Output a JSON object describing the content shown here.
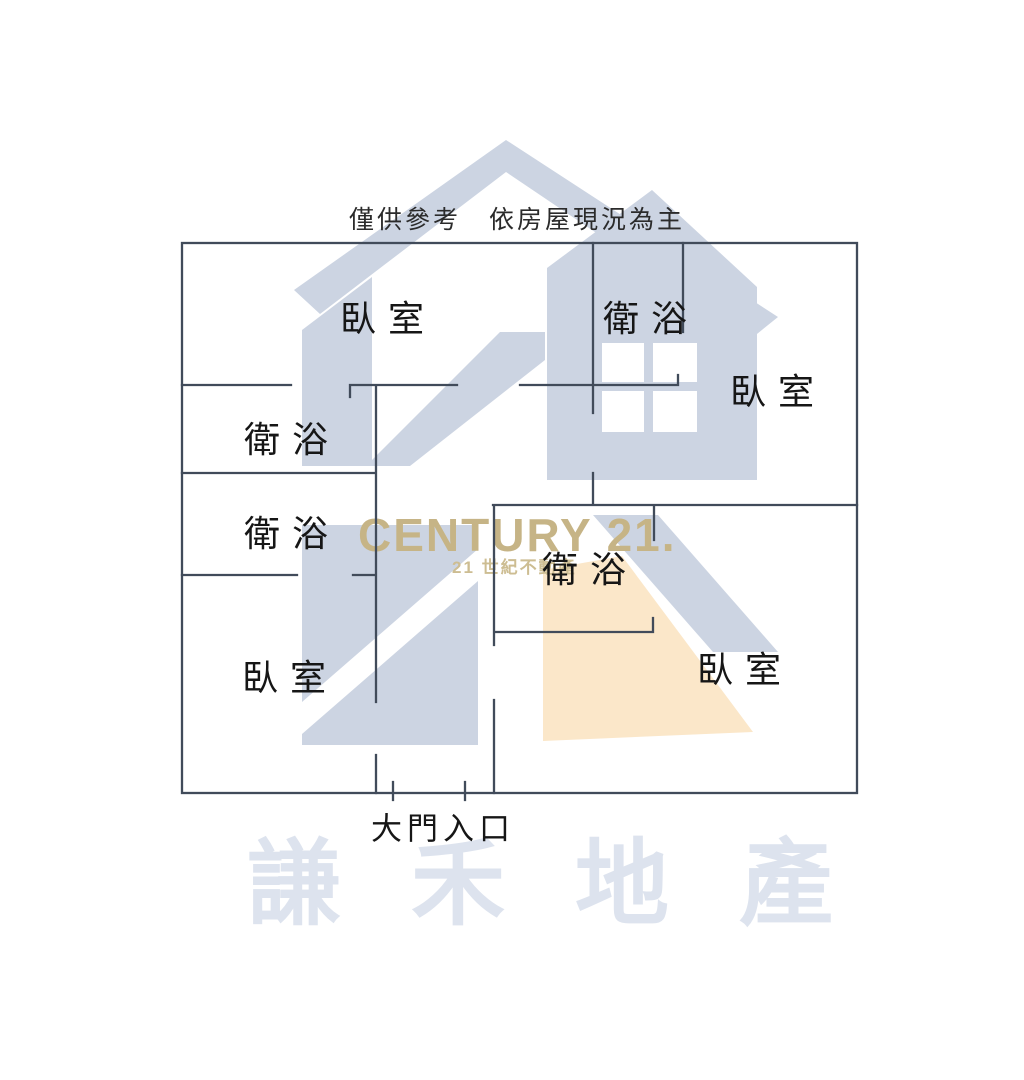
{
  "disclaimer": "僅供參考　依房屋現況為主",
  "rooms": {
    "bedroom_top_left": "臥室",
    "bath_top": "衛浴",
    "bedroom_top_right": "臥室",
    "bath_left_upper": "衛浴",
    "bath_left_lower": "衛浴",
    "bedroom_bottom_left": "臥室",
    "bath_center": "衛浴",
    "bedroom_bottom_right": "臥室"
  },
  "entrance": {
    "label": "大門入口"
  },
  "watermarks": {
    "brand": "CENTURY 21.",
    "brand_sub": "21 世紀不動產",
    "agency": "謙禾地產",
    "colors": {
      "brand_gold": "#c6b486",
      "logo_blue": "#ccd4e2",
      "logo_peach": "#fbe7c9",
      "agency_light_blue": "#dde3ee",
      "wall_line": "#414b5a"
    }
  }
}
